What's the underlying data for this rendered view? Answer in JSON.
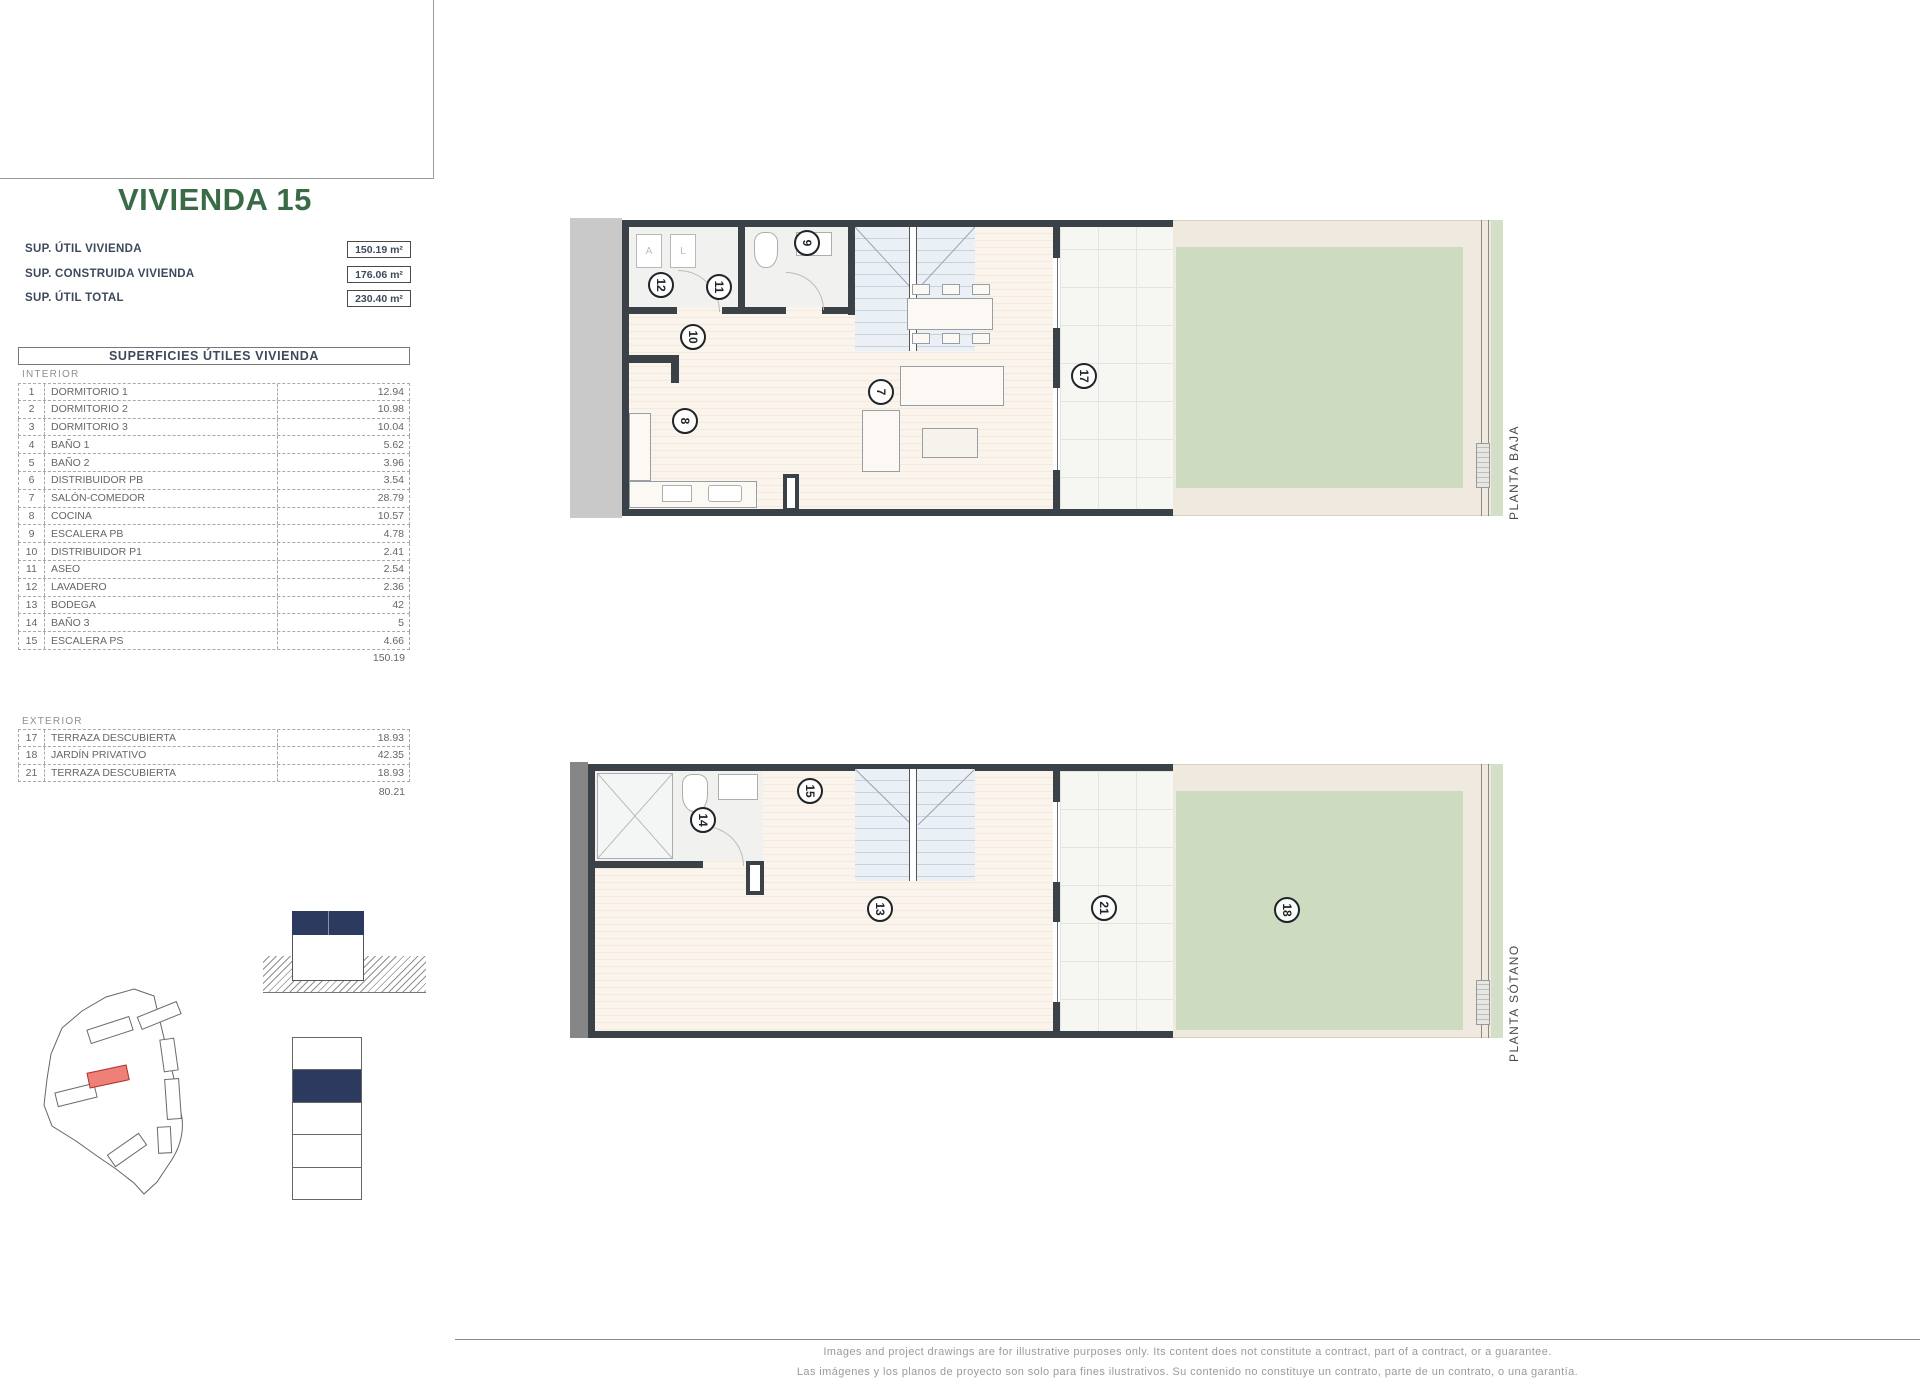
{
  "sheet": {
    "title": "VIVIENDA 15"
  },
  "stats": [
    {
      "label": "SUP. ÚTIL VIVIENDA",
      "value": "150.19 m²"
    },
    {
      "label": "SUP. CONSTRUIDA VIVIENDA",
      "value": "176.06 m²"
    },
    {
      "label": "SUP. ÚTIL TOTAL",
      "value": "230.40 m²"
    }
  ],
  "surfaces": {
    "header": "SUPERFICIES ÚTILES VIVIENDA",
    "interior": {
      "label": "INTERIOR",
      "rows": [
        {
          "num": "1",
          "name": "DORMITORIO 1",
          "value": "12.94"
        },
        {
          "num": "2",
          "name": "DORMITORIO 2",
          "value": "10.98"
        },
        {
          "num": "3",
          "name": "DORMITORIO 3",
          "value": "10.04"
        },
        {
          "num": "4",
          "name": "BAÑO 1",
          "value": "5.62"
        },
        {
          "num": "5",
          "name": "BAÑO 2",
          "value": "3.96"
        },
        {
          "num": "6",
          "name": "DISTRIBUIDOR PB",
          "value": "3.54"
        },
        {
          "num": "7",
          "name": "SALÓN-COMEDOR",
          "value": "28.79"
        },
        {
          "num": "8",
          "name": "COCINA",
          "value": "10.57"
        },
        {
          "num": "9",
          "name": "ESCALERA PB",
          "value": "4.78"
        },
        {
          "num": "10",
          "name": "DISTRIBUIDOR P1",
          "value": "2.41"
        },
        {
          "num": "11",
          "name": "ASEO",
          "value": "2.54"
        },
        {
          "num": "12",
          "name": "LAVADERO",
          "value": "2.36"
        },
        {
          "num": "13",
          "name": "BODEGA",
          "value": "42"
        },
        {
          "num": "14",
          "name": "BAÑO 3",
          "value": "5"
        },
        {
          "num": "15",
          "name": "ESCALERA PS",
          "value": "4.66"
        }
      ],
      "total": "150.19"
    },
    "exterior": {
      "label": "EXTERIOR",
      "rows": [
        {
          "num": "17",
          "name": "TERRAZA DESCUBIERTA",
          "value": "18.93"
        },
        {
          "num": "18",
          "name": "JARDÍN PRIVATIVO",
          "value": "42.35"
        },
        {
          "num": "21",
          "name": "TERRAZA DESCUBIERTA",
          "value": "18.93"
        }
      ],
      "total": "80.21"
    }
  },
  "plans": [
    {
      "label": "PLANTA BAJA",
      "appliances": [
        "A",
        "L"
      ],
      "markers": [
        {
          "num": "12",
          "x": 91,
          "y": 67
        },
        {
          "num": "11",
          "x": 149,
          "y": 69
        },
        {
          "num": "9",
          "x": 237,
          "y": 25
        },
        {
          "num": "10",
          "x": 123,
          "y": 119
        },
        {
          "num": "8",
          "x": 115,
          "y": 203
        },
        {
          "num": "7",
          "x": 311,
          "y": 174
        },
        {
          "num": "17",
          "x": 514,
          "y": 158
        }
      ]
    },
    {
      "label": "PLANTA SÓTANO",
      "markers": [
        {
          "num": "14",
          "x": 133,
          "y": 58
        },
        {
          "num": "15",
          "x": 240,
          "y": 29
        },
        {
          "num": "13",
          "x": 310,
          "y": 147
        },
        {
          "num": "21",
          "x": 534,
          "y": 146
        },
        {
          "num": "18",
          "x": 717,
          "y": 148
        }
      ]
    }
  ],
  "footer": {
    "line1": "Images and project drawings are for illustrative purposes only. Its content does not constitute a contract, part of a contract, or a guarantee.",
    "line2": "Las imágenes y los planos de proyecto son solo para fines ilustrativos. Su contenido no constituye un contrato, parte de un contrato, o una garantía."
  },
  "colors": {
    "title_green": "#3A6B47",
    "navy_block": "#2D3A5F",
    "highlight_red": "#EF8078",
    "lawn_green": "#CDDCC1",
    "wall_dark": "#3B4247"
  }
}
